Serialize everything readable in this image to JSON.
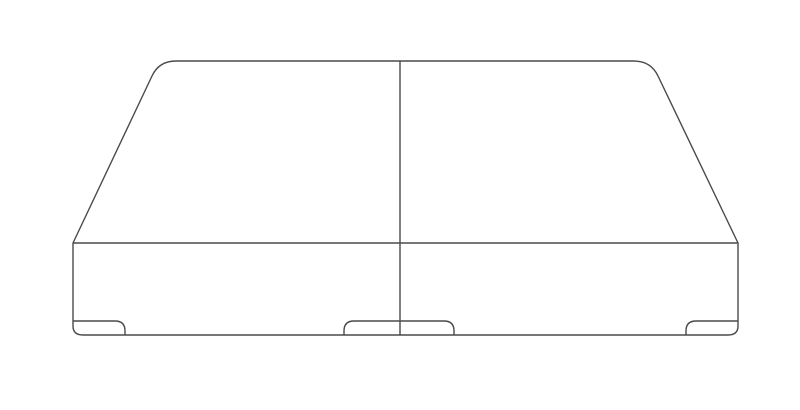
{
  "canvas": {
    "width": 800,
    "height": 410,
    "background_color": "#ffffff"
  },
  "illustration": {
    "subject": "split-foundation-box-spring-line-drawing",
    "stroke_color": "#4a4a4a",
    "stroke_width": 1.4,
    "viewbox": "0 0 800 410",
    "paths": {
      "outer_silhouette": "M 73 326 L 73 243 L 152 76 Q 159 61 176 61 L 634 61 Q 651 61 658 76 L 738 243 L 738 326 Q 738 335 728 335 L 83 335 Q 73 335 73 326 Z",
      "front_top_edge": "M 73 243 L 738 243",
      "center_split": "M 400 61 L 400 335",
      "left_corner_foot": "M 73 321 L 115 321 Q 125 321 125 331 L 125 335",
      "center_feet": "M 344 335 L 344 331 Q 344 321 354 321 L 444 321 Q 454 321 454 331 L 454 335",
      "right_corner_foot": "M 738 321 L 696 321 Q 686 321 686 331 L 686 335"
    }
  }
}
